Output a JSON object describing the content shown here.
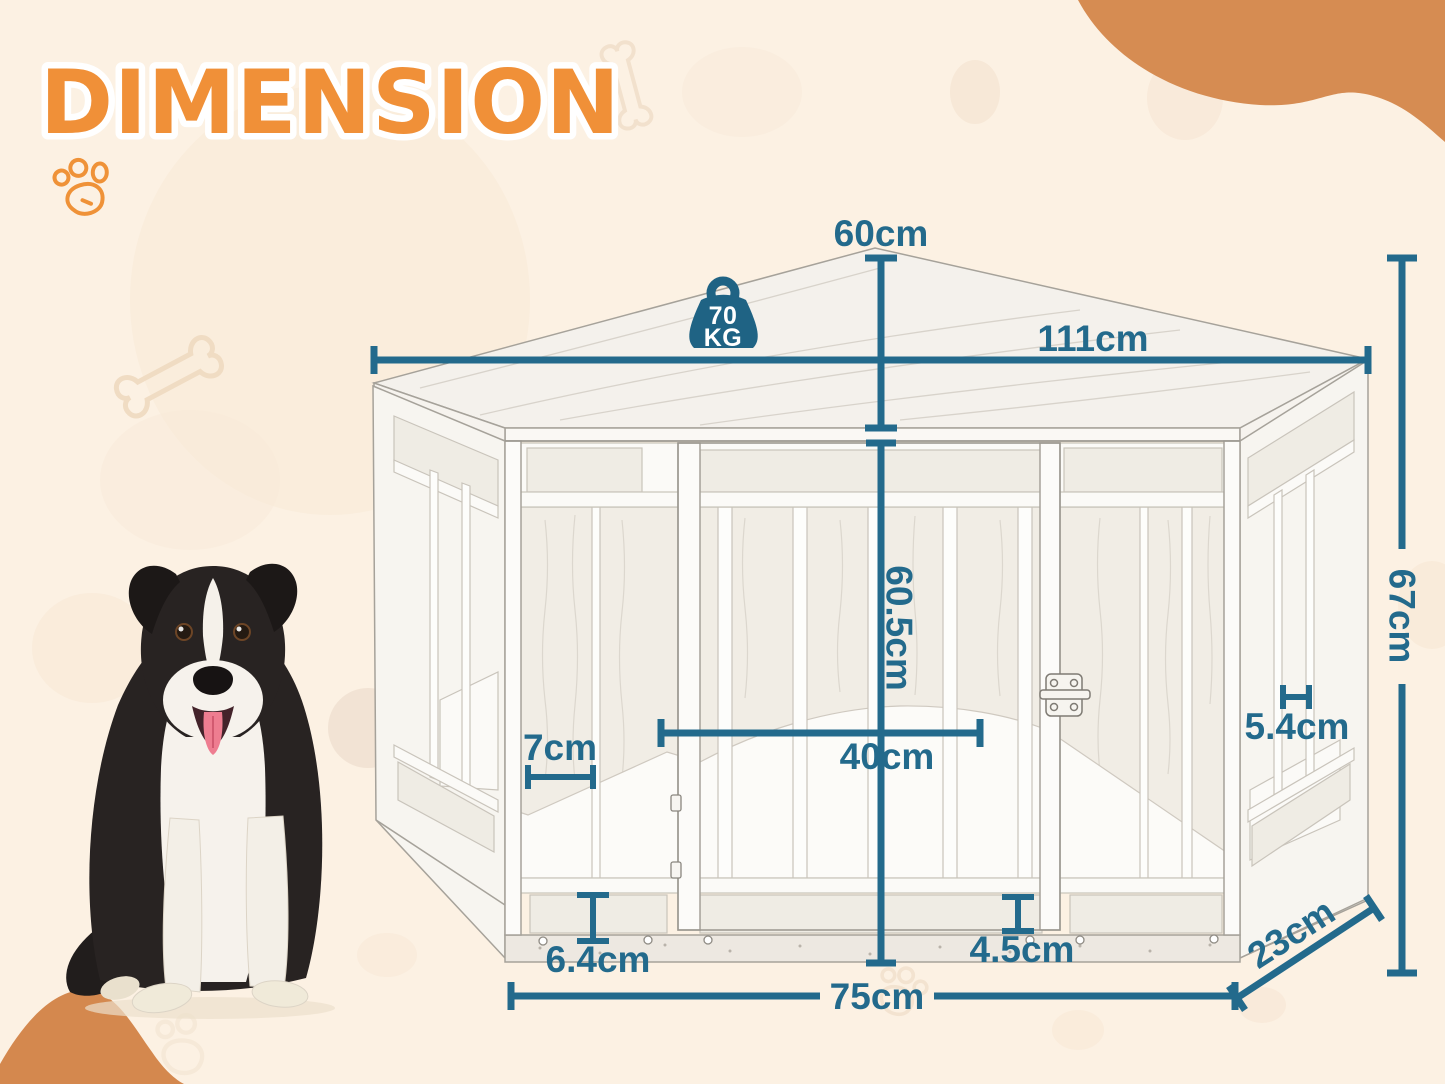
{
  "page": {
    "title": "DIMENSION"
  },
  "weight_badge": {
    "value": "70",
    "unit": "KG"
  },
  "dimensions": {
    "top_height": "60cm",
    "top_width": "111cm",
    "overall_height": "67cm",
    "inner_height": "60.5cm",
    "left_panel_width": "7cm",
    "door_width": "40cm",
    "side_bar_gap": "5.4cm",
    "bottom_panel_height": "6.4cm",
    "bottom_rail_height": "4.5cm",
    "front_width": "75cm",
    "depth": "23cm"
  },
  "colors": {
    "background": "#fcf1e3",
    "accent_orange": "#f09038",
    "blob_orange": "#d68c52",
    "dimension_teal": "#236a8c"
  }
}
